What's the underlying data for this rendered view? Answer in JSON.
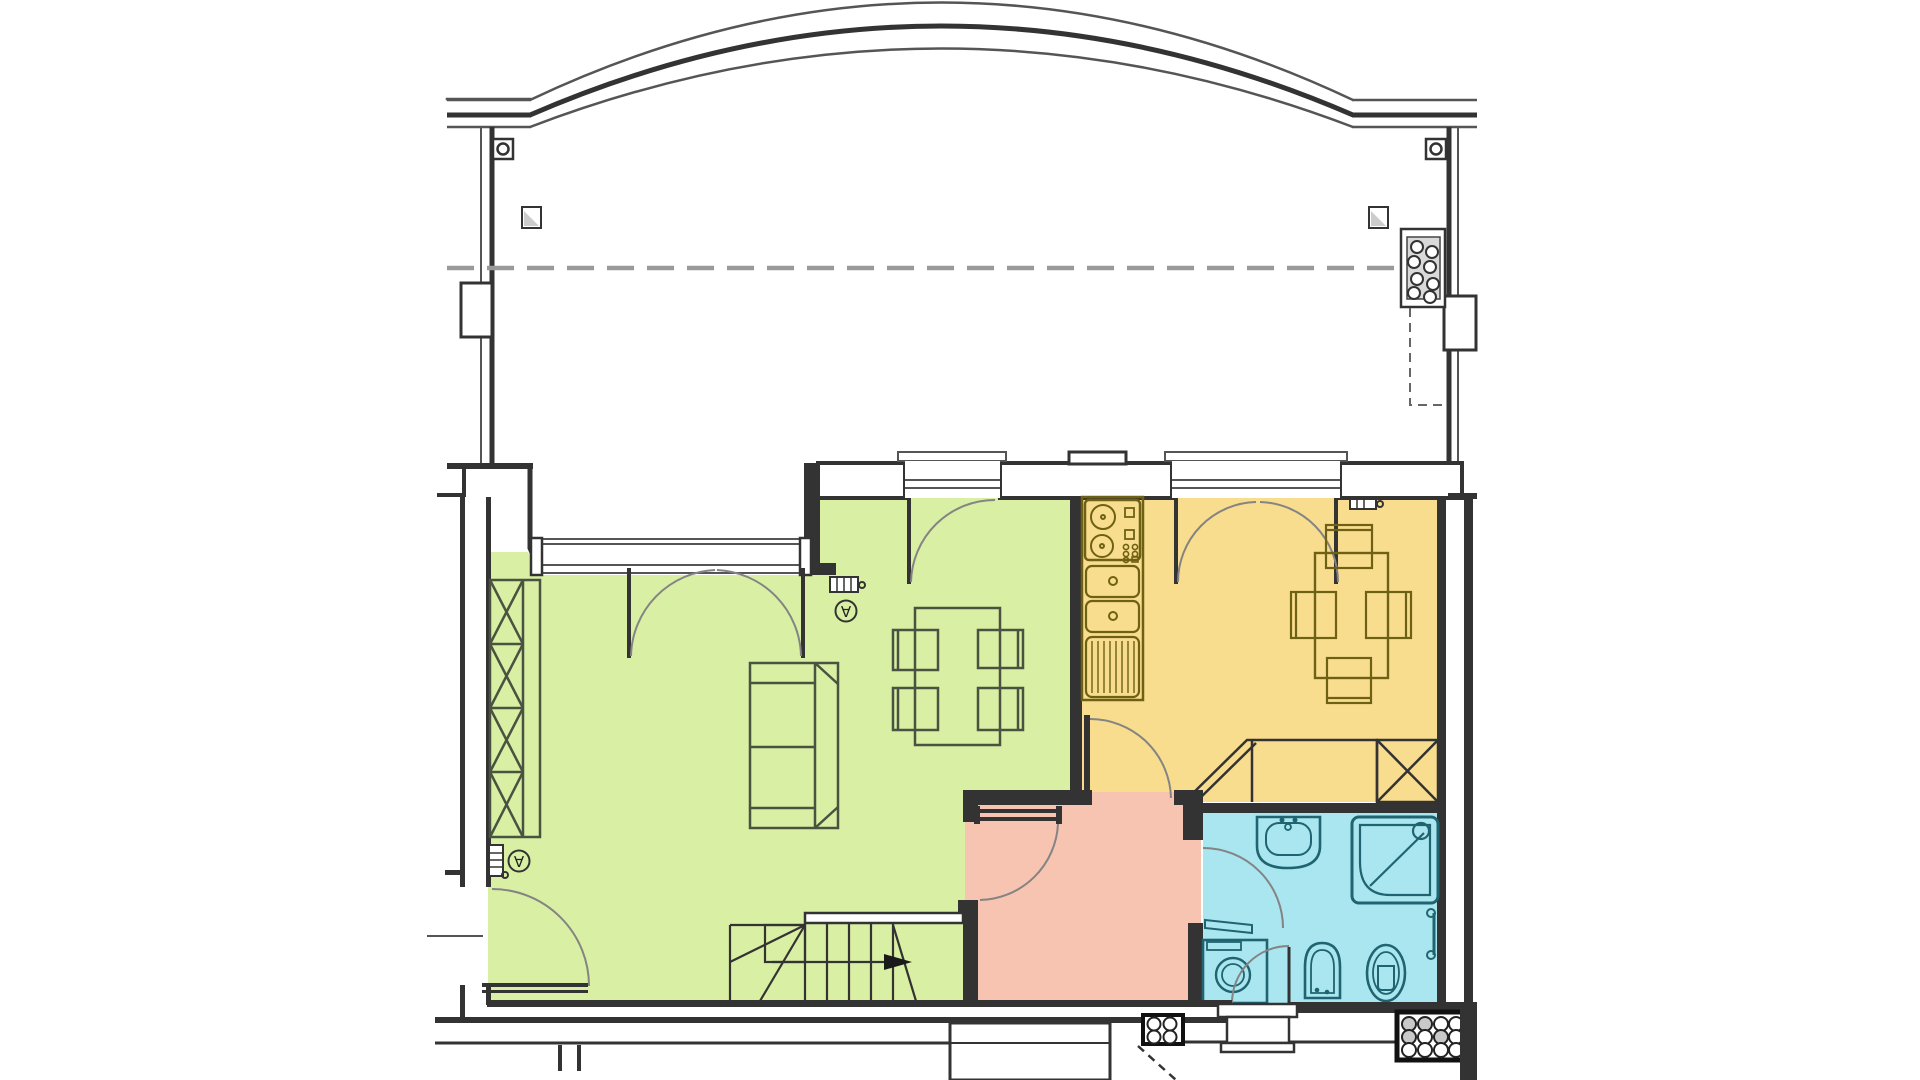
{
  "document": {
    "kind": "architectural-floor-plan",
    "view": "top-down ground floor plan",
    "visible_text": "none",
    "vent_glyph": "∀"
  },
  "colors": {
    "living": "#d9efa4",
    "kitchen": "#f9dd8e",
    "hallway": "#f6c4b1",
    "bathroom": "#aae6ef",
    "wall": "#333333",
    "line": "#555555",
    "swing": "#848484",
    "furniture_green": "#4a5340",
    "fixture_kitchen": "#6f6114",
    "fixture_bath": "#1f6470",
    "shading": "#cccccc",
    "dashed": "#999999"
  },
  "rooms": [
    {
      "id": "terrace",
      "name": "terrace",
      "color": "white",
      "features": [
        "arched-boundary-wall",
        "dashed-awning-line",
        "planter-box",
        "wall-pillar-left",
        "wall-pillar-right",
        "gate-hinge-left",
        "gate-hinge-right",
        "drain-square-left",
        "drain-square-right"
      ]
    },
    {
      "id": "living-dining",
      "name": "living-dining-room",
      "color_key": "living",
      "features": [
        "bay-window",
        "french-balcony-door",
        "single-balcony-door",
        "wardrobe-x-shelving",
        "sofa",
        "dining-table",
        "four-chairs",
        "radiator",
        "vent-symbol",
        "vent-grille",
        "entrance-door",
        "staircase-with-winders",
        "door-to-hallway"
      ]
    },
    {
      "id": "kitchen",
      "name": "kitchen",
      "color_key": "kitchen",
      "features": [
        "french-balcony-door",
        "cooktop-two-burners",
        "double-sink",
        "drainboard",
        "kitchen-table",
        "four-chairs",
        "corner-bench",
        "x-cabinet",
        "vent-grille",
        "door-to-hallway"
      ]
    },
    {
      "id": "hallway",
      "name": "hallway",
      "color_key": "hallway",
      "features": [
        "door-to-living-room",
        "door-to-kitchen",
        "doorway-to-bathroom"
      ]
    },
    {
      "id": "bathroom",
      "name": "bathroom",
      "color_key": "bathroom",
      "features": [
        "washbasin",
        "shower-cabin",
        "towel-rail",
        "washing-machine",
        "bidet",
        "toilet",
        "exterior-back-door"
      ]
    }
  ],
  "exterior": {
    "features": [
      "gas-meter-box-4-circles",
      "drain-grate-12-circles",
      "back-porch-steps",
      "front-porch-ticks",
      "foundation-lines"
    ]
  }
}
